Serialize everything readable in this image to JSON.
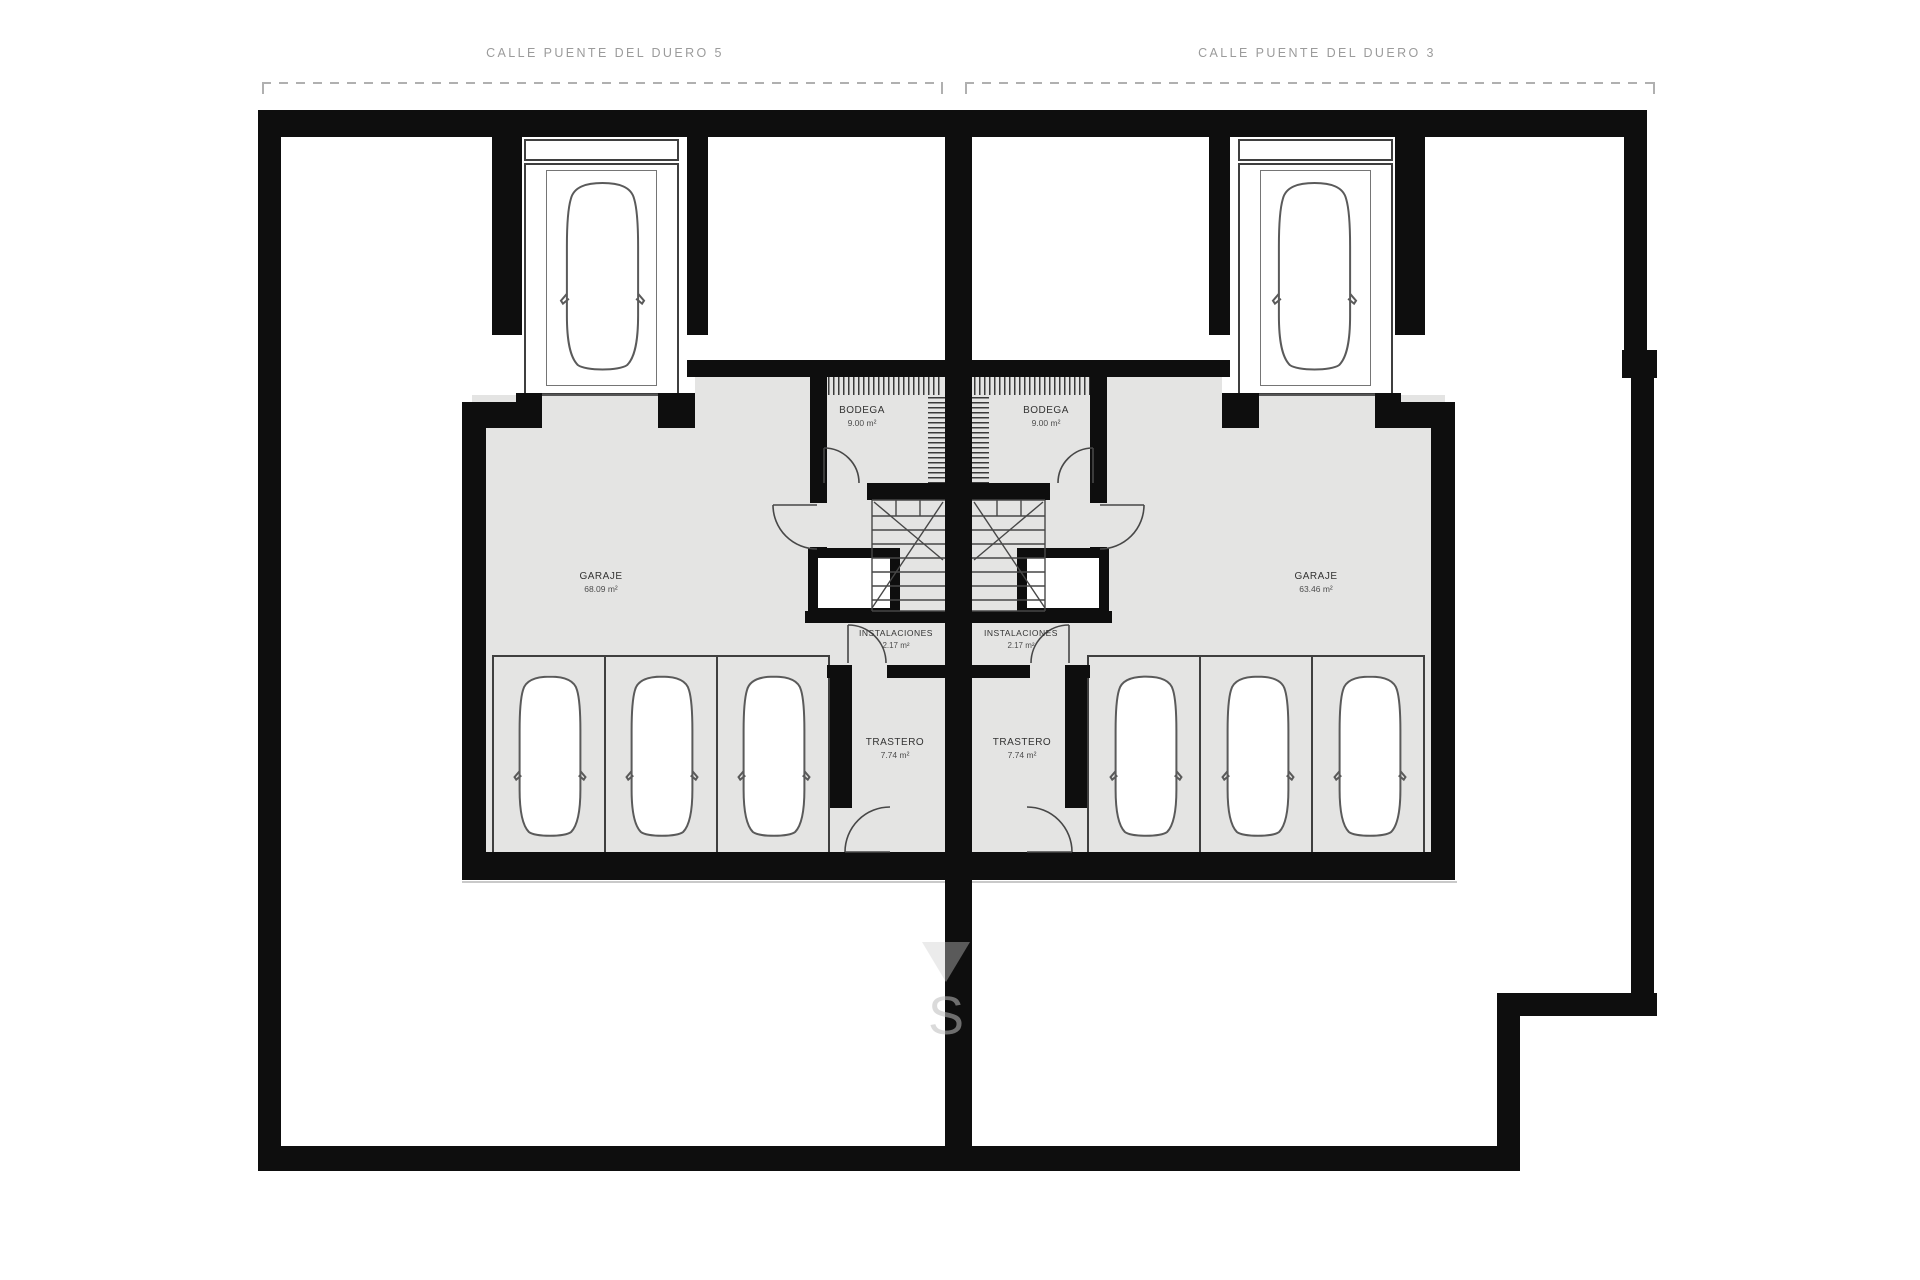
{
  "streets": {
    "left": "CALLE PUENTE DEL DUERO 5",
    "right": "CALLE PUENTE DEL DUERO 3"
  },
  "units": {
    "left": {
      "garaje": {
        "name": "GARAJE",
        "area": "68.09 m²"
      },
      "bodega": {
        "name": "BODEGA",
        "area": "9.00 m²"
      },
      "instalaciones": {
        "name": "INSTALACIONES",
        "area": "2.17 m²"
      },
      "trastero": {
        "name": "TRASTERO",
        "area": "7.74 m²"
      }
    },
    "right": {
      "garaje": {
        "name": "GARAJE",
        "area": "63.46 m²"
      },
      "bodega": {
        "name": "BODEGA",
        "area": "9.00 m²"
      },
      "instalaciones": {
        "name": "INSTALACIONES",
        "area": "2.17 m²"
      },
      "trastero": {
        "name": "TRASTERO",
        "area": "7.74 m²"
      }
    }
  },
  "watermark": {
    "letter": "S"
  },
  "colors": {
    "wall": "#0e0e0e",
    "floor": "#e4e4e3",
    "line": "#3f3f3f"
  }
}
